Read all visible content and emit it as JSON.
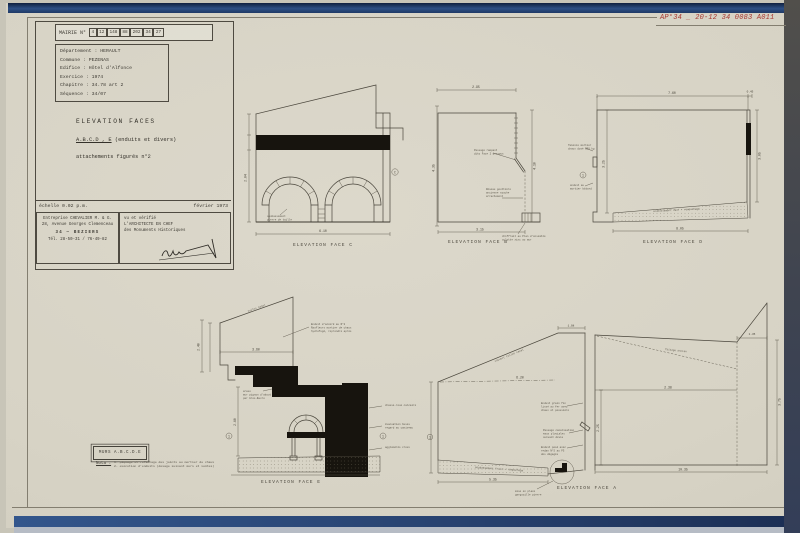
{
  "meta": {
    "red_ref": "AP°34 _ 20-12 34 0083 A011"
  },
  "title_block": {
    "header_label": "MAIRIE N°",
    "header_boxes": [
      "4",
      "12",
      "148",
      "88",
      "202",
      "34",
      "27"
    ],
    "info_lines": [
      "Département : HERAULT",
      "Commune : PEZENAS",
      "Edifice : Hôtel d'Alfonce",
      "Exercice : 1974",
      "Chapitre : 34.78 art 2",
      "Séquence : 34/07"
    ],
    "subject_line1": "ELEVATION FACES",
    "subject_line2a": "A.B.C.D , E",
    "subject_line2b": " (enduits et divers)",
    "subject_line3": "attachements figurés n°2",
    "scale": "échelle 0.02 p.m.",
    "date": "février 1973",
    "contractor_lines": [
      "Entreprise CHEVALIER M. & G.",
      "28, Avenue Georges Clemenceau",
      "34 — BEZIERS",
      "Tél. 28-50-31  /  76-49-82"
    ],
    "verif_lines": [
      "vu et vérifié",
      "L'ARCHITECTE EN CHEF",
      "des Monuments Historiques"
    ]
  },
  "drawings": {
    "face_c": {
      "caption": "ELEVATION FACE C",
      "dim_width": "6.10",
      "dim_height": "2.04",
      "mark": "C",
      "note1": "soubassement",
      "note2": "pierre de taille"
    },
    "face_b": {
      "caption": "ELEVATION FACE B",
      "dim_top": "2.95",
      "dim_left": "4.35",
      "dim_right": "4.10",
      "dim_bottom": "3.15",
      "note_a1": "Passage rampant",
      "note_a2": "dito Face 2 dessous",
      "note_b1": "Réseau gouttière",
      "note_b2": "ancienne souche",
      "note_b3": "arrachement",
      "note_c1": "chiffrait au Plan d'ensemble",
      "note_c2": "culotte zinc au mur"
    },
    "face_d": {
      "caption": "ELEVATION FACE D",
      "dim_top": "7.60",
      "dim_top2": "0.45",
      "dim_left": "3.25",
      "dim_right": "3.05",
      "dim_bottom": "8.05",
      "band_label": "soubassement neuf + rempochage",
      "mark": "1",
      "note_a1": "faïence mortier",
      "note_a2": "chaux dosé 350 kg",
      "note_b1": "enduit au",
      "note_b2": "mortier bâtard"
    },
    "face_e": {
      "caption": "ELEVATION FACE E",
      "dim_h": "3.60",
      "dim_left": "2.40",
      "dim_wall": "2.60",
      "mark_left": "1",
      "mark_right": "1",
      "roof_note": "tuiles canal",
      "note_top1": "Enduit d'accord au N°2",
      "note_top2": "Raufleurs mortier de chaux",
      "note_top3": "hydrofugé, reprendre après",
      "note_mid1": "arase",
      "note_mid2": "mur pignon d'about",
      "note_mid3": "par Gros-Œuvre",
      "note_r1a": "chasse-roue calcaire",
      "note_r2a": "évacuation buses",
      "note_r2b": "regard au caniveau",
      "note_r3a": "agglomérés creux"
    },
    "face_a": {
      "caption": "ELEVATION FACE A",
      "dim_flat": "1.08",
      "dim_dash": "6.20",
      "dim_mid": "2.38",
      "dim_right": "3.75",
      "dim_tr": "1.35",
      "dim_bottom": "10.35",
      "dim_bl": "5.35",
      "dim_wall": "2.25",
      "mark": "1",
      "slope_note": "couvert tuiles canal",
      "roof_label": "faîtage ancien",
      "band_label": "soubassement fruit + rempochage",
      "note1a": "Enduit grain fin",
      "note1b": "lissé au fer avec",
      "note1c": "chaux et poussière",
      "note2a": "Passage canalisation",
      "note2b": "eaux pluviales",
      "note2c": "suivant devis",
      "note3a": "Enduit posé avec",
      "note3b": "redan N°5 au FG",
      "note3c": "des dégagés",
      "detail_note1": "mise en place",
      "detail_note2": "gargouille pierre"
    }
  },
  "nota": {
    "box_label": "MURS A.B.C.D.E",
    "label": "Nota :",
    "lines": [
      "1- piquage et refichage des joints au mortier de chaux",
      "2- exécution d'enduits (dosage suivant murs et voûtes)"
    ]
  }
}
